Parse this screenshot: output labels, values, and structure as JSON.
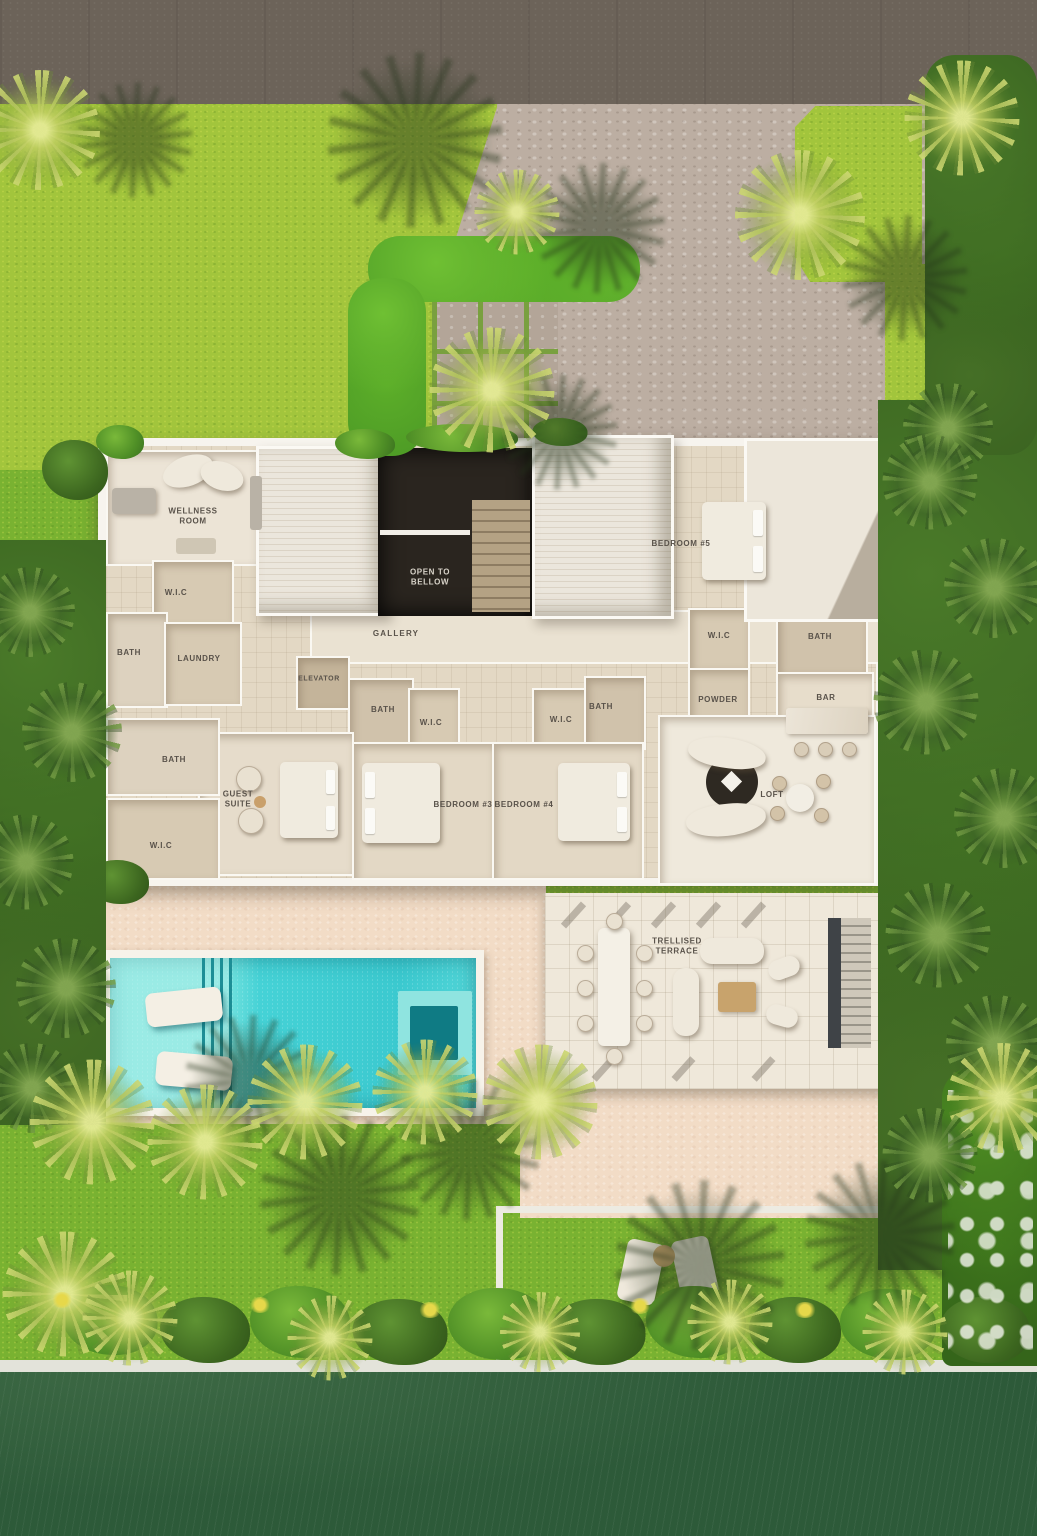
{
  "labels": [
    {
      "id": "wellness-room",
      "text": "WELLNESS ROOM"
    },
    {
      "id": "wic-upper-left",
      "text": "W.I.C"
    },
    {
      "id": "bath-upper-left",
      "text": "BATH"
    },
    {
      "id": "laundry",
      "text": "LAUNDRY"
    },
    {
      "id": "gallery",
      "text": "GALLERY"
    },
    {
      "id": "elevator",
      "text": "ELEVATOR"
    },
    {
      "id": "open-to-bellow",
      "text": "OPEN TO BELLOW"
    },
    {
      "id": "bedroom-5",
      "text": "BEDROOM #5"
    },
    {
      "id": "wic-bedroom-5",
      "text": "W.I.C"
    },
    {
      "id": "bath-bedroom-5",
      "text": "BATH"
    },
    {
      "id": "powder",
      "text": "POWDER"
    },
    {
      "id": "bar",
      "text": "BAR"
    },
    {
      "id": "loft",
      "text": "LOFT"
    },
    {
      "id": "bath-bedroom-3",
      "text": "BATH"
    },
    {
      "id": "wic-bedroom-3",
      "text": "W.I.C"
    },
    {
      "id": "wic-bedroom-4",
      "text": "W.I.C"
    },
    {
      "id": "bath-bedroom-4",
      "text": "BATH"
    },
    {
      "id": "bedroom-3",
      "text": "BEDROOM #3"
    },
    {
      "id": "bedroom-4",
      "text": "BEDROOM #4"
    },
    {
      "id": "guest-suite",
      "text": "GUEST SUITE"
    },
    {
      "id": "bath-guest-suite",
      "text": "BATH"
    },
    {
      "id": "wic-guest-suite",
      "text": "W.I.C"
    },
    {
      "id": "trellised-terrace",
      "text": "TRELLISED TERRACE"
    }
  ],
  "colors": {
    "road": "#6c6359",
    "lawn": "#a2c53c",
    "lawn_bottom": "#79b231",
    "hedge": "#57ae2b",
    "foliage_dark": "#335a1d",
    "palm_light": "#c0ce62",
    "driveway_pavers": "#bcaea2",
    "house_wall": "#f7f4ee",
    "floor_tile": "#d7cab3",
    "roof_rib": "#ebe6dc",
    "void_dark": "#2a251f",
    "pool_water": "#41cfd3",
    "pool_lane": "#1d8e96",
    "spa_bench": "#0f7b84",
    "deck": "#f2dcc6",
    "terrace_tile": "#efe8da",
    "canal_water": "#2d5a39",
    "seawall": "#e3e3da",
    "label_text": "#59524a"
  }
}
